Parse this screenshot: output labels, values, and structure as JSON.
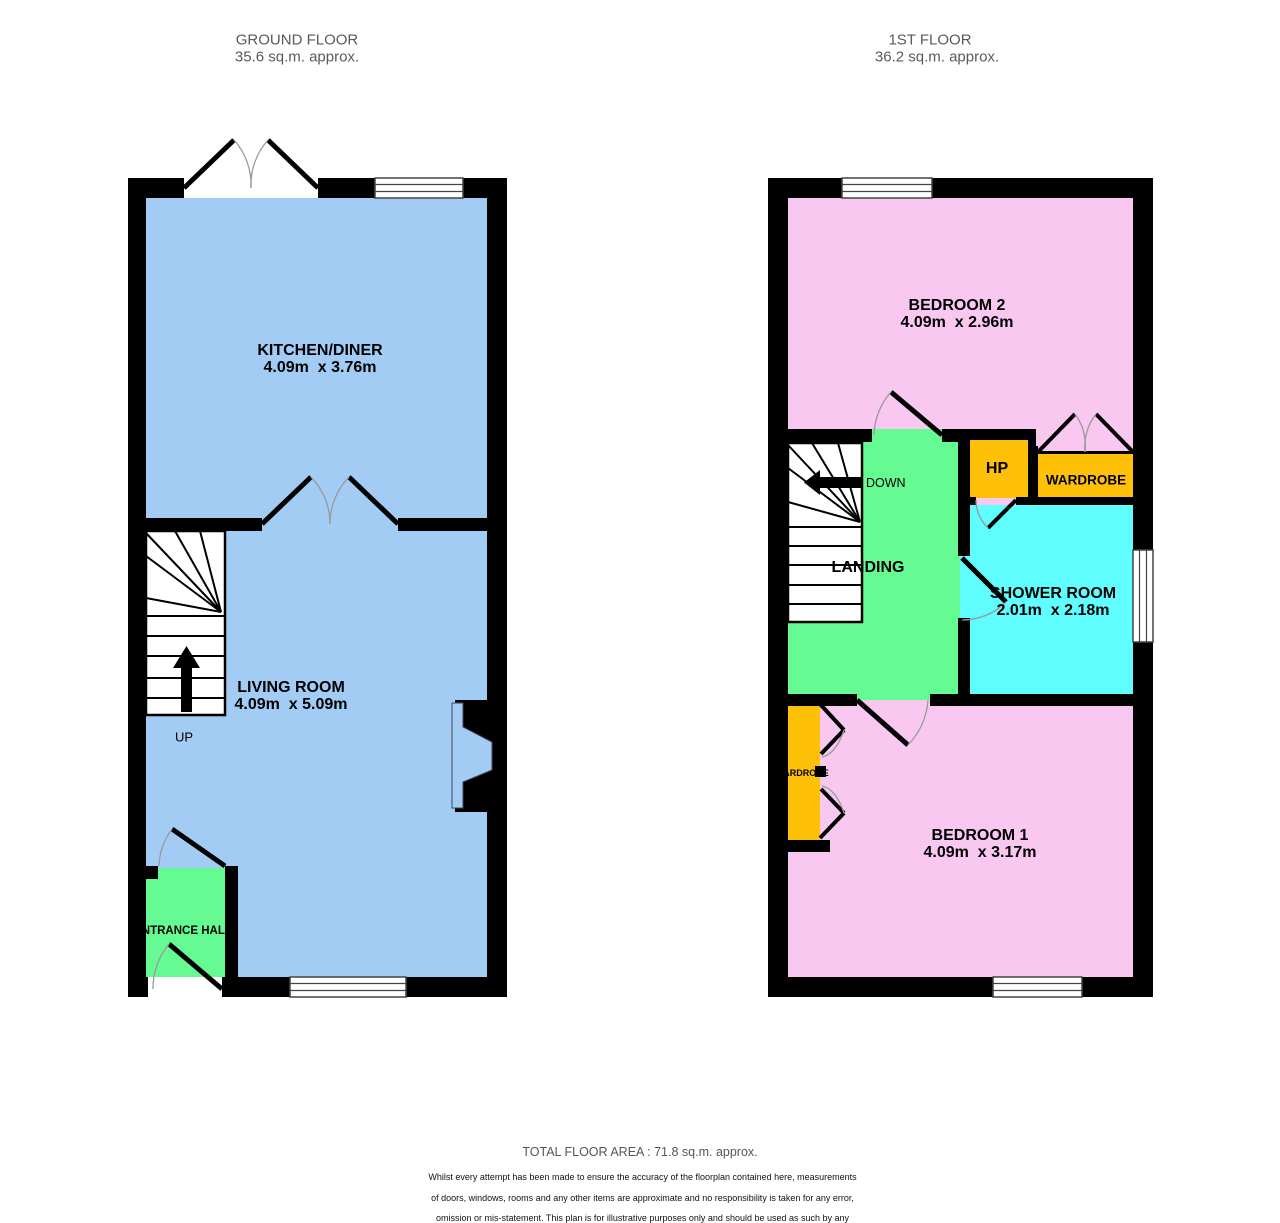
{
  "floors": {
    "ground": {
      "title": "GROUND FLOOR",
      "area": "35.6 sq.m. approx.",
      "rooms": {
        "kitchen_diner": {
          "name": "KITCHEN/DINER",
          "dims": "4.09m  x 3.76m"
        },
        "living_room": {
          "name": "LIVING ROOM",
          "dims": "4.09m  x 5.09m"
        },
        "entrance_hall": {
          "name": "ENTRANCE HALL"
        }
      },
      "stairs_label": "UP"
    },
    "first": {
      "title": "1ST FLOOR",
      "area": "36.2 sq.m. approx.",
      "rooms": {
        "bedroom2": {
          "name": "BEDROOM 2",
          "dims": "4.09m  x 2.96m"
        },
        "bedroom1": {
          "name": "BEDROOM 1",
          "dims": "4.09m  x 3.17m"
        },
        "shower_room": {
          "name": "SHOWER ROOM",
          "dims": "2.01m  x 2.18m"
        },
        "landing": {
          "name": "LANDING"
        },
        "hp": {
          "name": "HP"
        },
        "wardrobe": {
          "name": "WARDROBE"
        },
        "wardrobe_bedroom1": {
          "name": "WARDROBE"
        }
      },
      "stairs_label": "DOWN"
    }
  },
  "footer": {
    "total_area": "TOTAL FLOOR AREA : 71.8 sq.m. approx.",
    "disclaimer_lines": [
      "Whilst every attempt has been made to ensure the accuracy of the floorplan contained here, measurements",
      "of doors, windows, rooms and any other items are approximate and no responsibility is taken for any error,",
      "omission or mis-statement. This plan is for illustrative purposes only and should be used as such by any",
      "prospective purchaser. The services, systems and appliances shown have not been tested and no guarantee",
      "as to their operability or efficiency can be given."
    ],
    "credit": "Made with Metropix ©2023"
  },
  "colors": {
    "room_blue": "#A3CCF5",
    "room_pink": "#F8C8F1",
    "room_green": "#66FA93",
    "room_cyan": "#5FFDFD",
    "room_orange": "#FFC008",
    "wall": "#000000"
  }
}
